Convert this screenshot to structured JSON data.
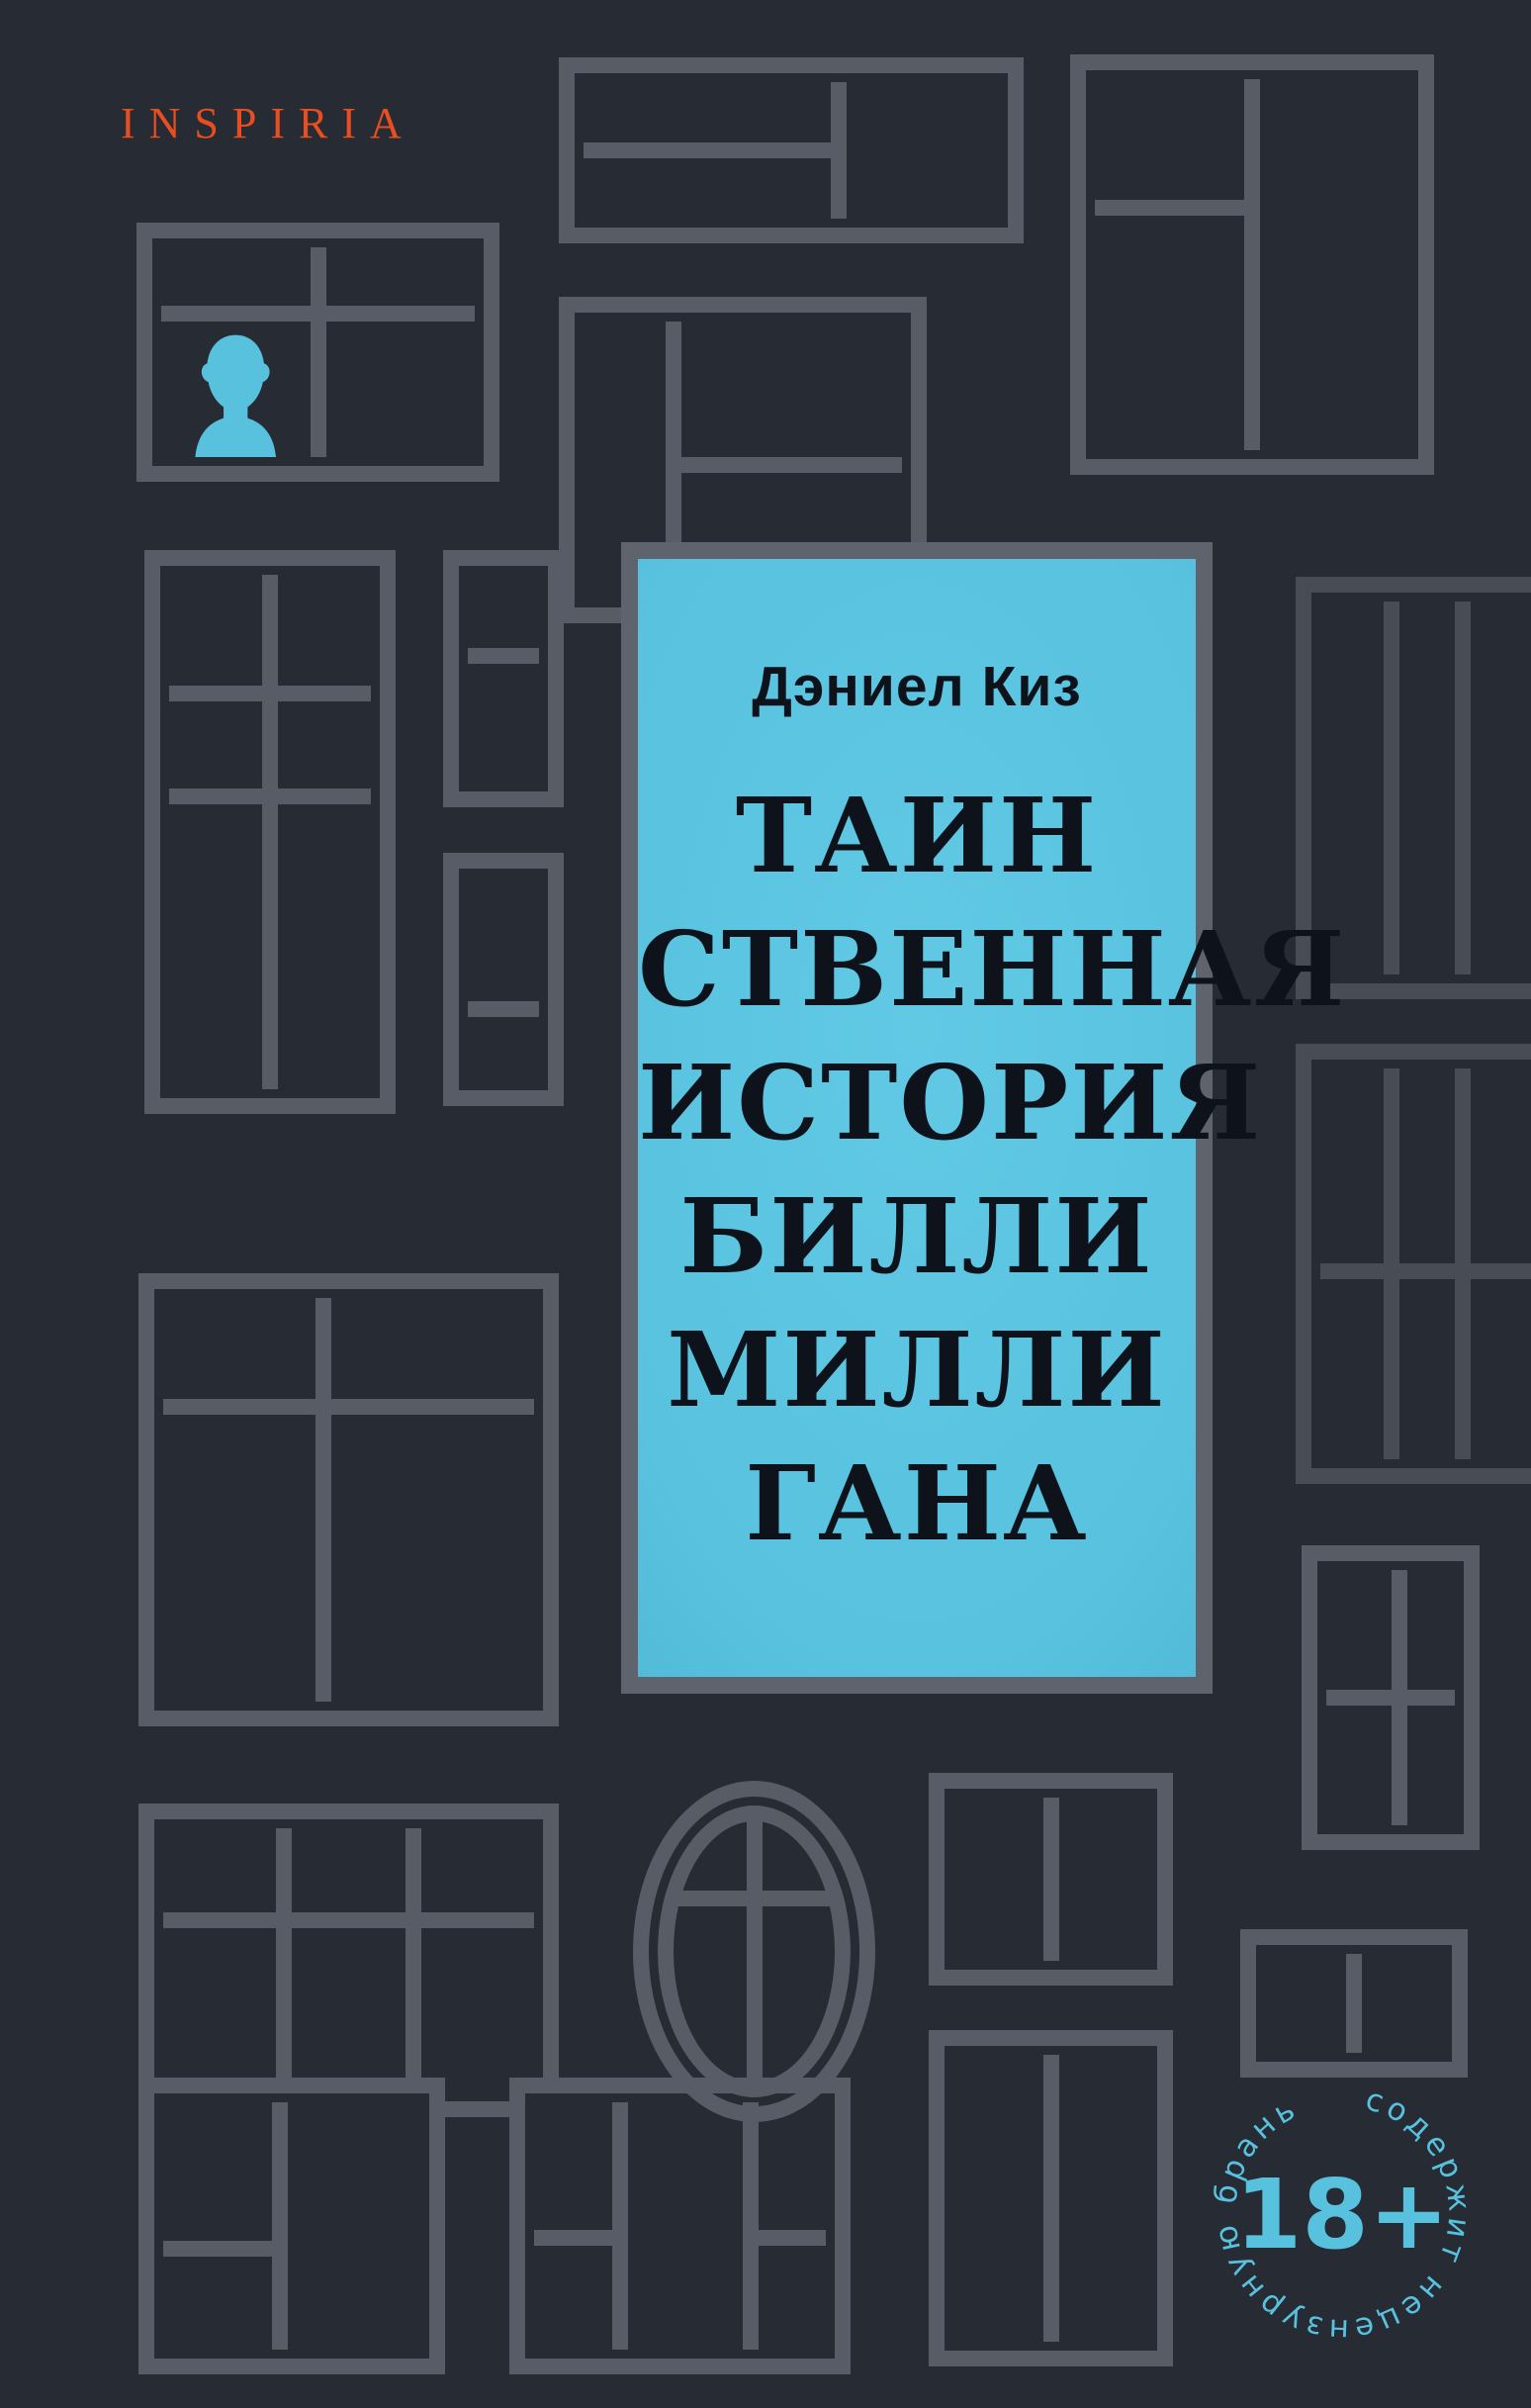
{
  "brand": {
    "label": "INSPIRIA"
  },
  "cover": {
    "author": "Дэниел Киз",
    "title_lines": [
      "ТАИН",
      "СТВЕННАЯ",
      "ИСТОРИЯ",
      "БИЛЛИ",
      "МИЛЛИ",
      "ГАНА"
    ]
  },
  "badge": {
    "age_label": "18+",
    "circle_text": "содержит  нецензурную  брань"
  },
  "icons": {
    "person": "person-silhouette-icon"
  },
  "colors": {
    "bg": "#272b34",
    "frame": "#575c66",
    "frame-dark": "#474c55",
    "frame-light": "#5e636d",
    "blue": "#57c1de",
    "blue-panel": "#58c2df",
    "orange": "#e84e20",
    "ink": "#0e131b"
  }
}
